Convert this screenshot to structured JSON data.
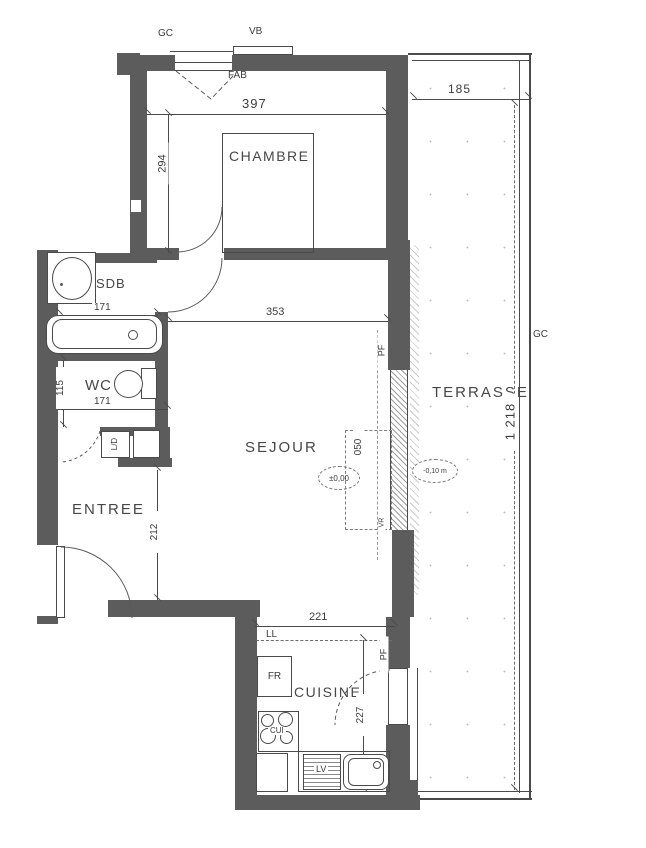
{
  "colors": {
    "wall": "#5c5c5c",
    "line": "#4a4a4a",
    "text": "#3c3c3c",
    "paper": "#ffffff"
  },
  "rooms": {
    "chambre": "CHAMBRE",
    "sdb": "SDB",
    "wc": "WC",
    "entree": "ENTREE",
    "sejour": "SEJOUR",
    "cuisine": "CUISINE",
    "terrasse": "TERRASSE"
  },
  "dimensions": {
    "chambre_width": "397",
    "chambre_height": "294",
    "terrasse_width": "185",
    "terrasse_length": "1 218",
    "sejour_width": "353",
    "sdb_width": "171",
    "wc_height": "115",
    "wc_width": "171",
    "entree_height": "212",
    "cuisine_width": "221",
    "cuisine_height": "227",
    "window_height": "050"
  },
  "annotations": {
    "gc_top": "GC",
    "vb": "VB",
    "fab": "FAB",
    "gc_right": "GC",
    "pf_sejour": "PF",
    "pf_cuisine": "PF",
    "ll": "LL",
    "fr": "FR",
    "cui": "CUI",
    "lv": "LV",
    "closet": "L/D",
    "vr": "VR",
    "level_sejour": "±0,00",
    "level_terrasse": "-0,10 m"
  }
}
